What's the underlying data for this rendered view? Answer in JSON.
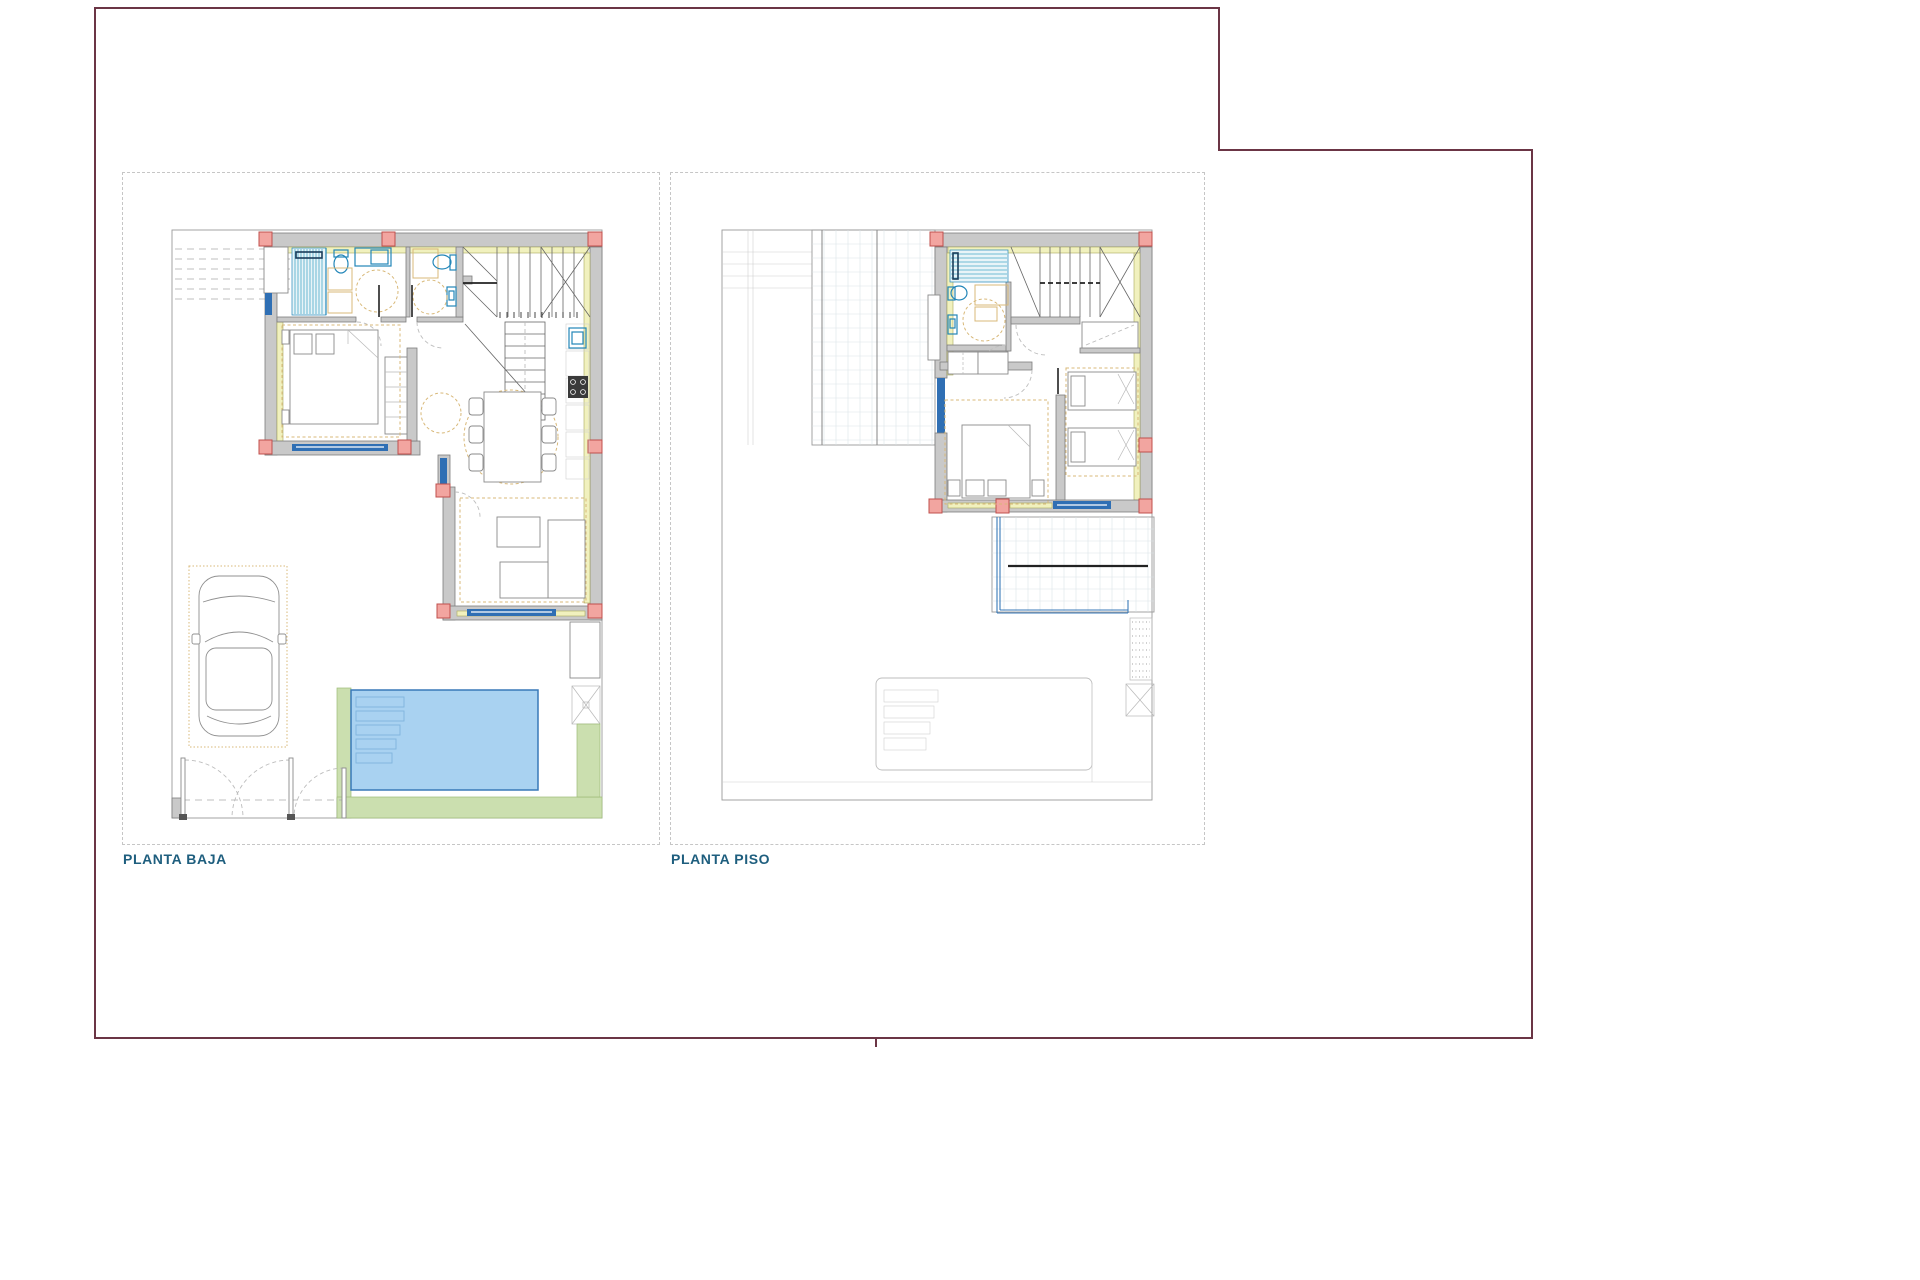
{
  "page": {
    "width": 1920,
    "height": 1280
  },
  "labels": {
    "left_plan": "PLANTA BAJA",
    "right_plan": "PLANTA PISO"
  },
  "theme": {
    "maroon": "#6B3545",
    "label_blue": "#1E5E7E",
    "panel_dash": "#C6C6C6",
    "property_line": "#9A9A9A",
    "wall_gray": "#C9C9C9",
    "wall_edge": "#7E7E7E",
    "insulation_yellow": "#F1F1BE",
    "insulation_edge": "#A9A95C",
    "column_pink": "#F2A5A0",
    "column_edge": "#C0504D",
    "fixture_blue": "#2286B8",
    "window_blue": "#2F6FB4",
    "furniture_tan": "#D8B878",
    "shower_fill": "#E8F4F8",
    "shower_stripe": "#49A8C8",
    "pool_fill": "#A9D2F1",
    "pool_edge": "#3879B8",
    "green_fill": "#CBDFAF",
    "green_edge": "#9DBB77",
    "grid_line": "#D9E2E8",
    "door_arc": "#BDBDBD"
  }
}
